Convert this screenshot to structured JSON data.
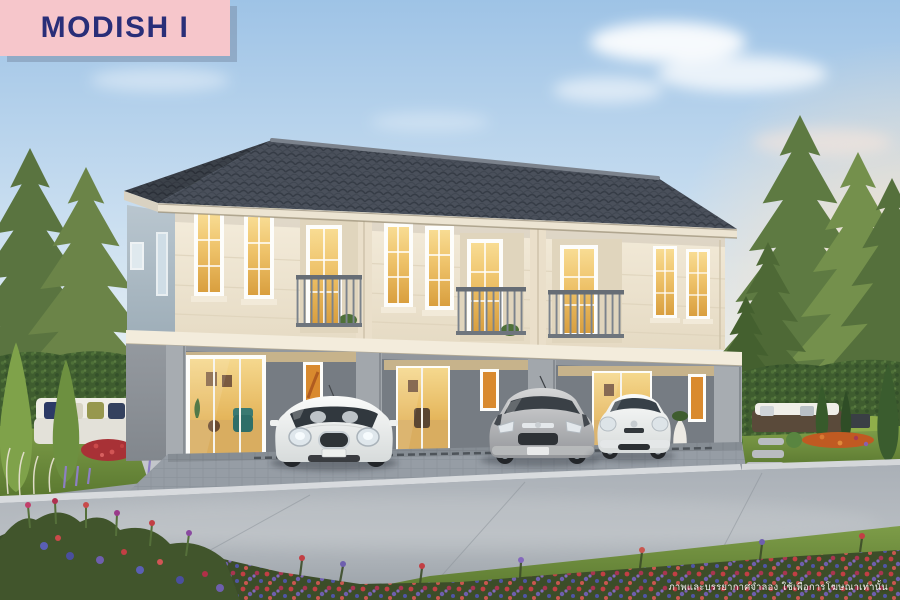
{
  "badge": {
    "label": "MODISH I",
    "background_color": "#f6c6cb",
    "text_color": "#292e78",
    "shadow_color": "#7e93ad"
  },
  "disclaimer": {
    "text": "ภาพและบรรยากาศจำลอง ใช้เพื่อการโฆษณาเท่านั้น",
    "color": "#ffffff"
  },
  "scene": {
    "type": "architectural-exterior-rendering",
    "subject": "Two-storey townhome block with three units, evening light",
    "elements": [
      "dark grey hip tile roof",
      "cream upper facade with warm lit white-framed windows",
      "three recessed balconies with grey railings",
      "grey ground floor with lit glass sliding doors and narrow art windows",
      "white mini hatchback, silver hatchback and white city hatchback parked in carports",
      "left garden with white outdoor sofa, hedge, cypresses and plume grass",
      "right garden with rattan sofa, fountain ornament, topiaries and orange flowers",
      "tall pine trees on both sides",
      "curved road with kerb and dense red-purple flower bed in foreground"
    ],
    "palette": {
      "sky_top": "#9ec3e6",
      "sky_horizon": "#f1f2ec",
      "sunset_glow": "#fde3c4",
      "roof": "#515864",
      "upper_facade": "#efe7d6",
      "side_facade": "#a9b6c0",
      "lower_facade": "#8e9399",
      "window_light": "#eec269",
      "foliage": "#56713c",
      "lawn": "#6b8c3e",
      "road": "#a8aeb5",
      "flower_red": "#c23f44",
      "flower_purple": "#6e5fae"
    },
    "cars": [
      {
        "name": "white-mini-hatchback",
        "color": "#f2f3f1"
      },
      {
        "name": "silver-hatchback",
        "color": "#b4b6b9"
      },
      {
        "name": "white-city-hatchback",
        "color": "#eef0f1"
      }
    ]
  }
}
